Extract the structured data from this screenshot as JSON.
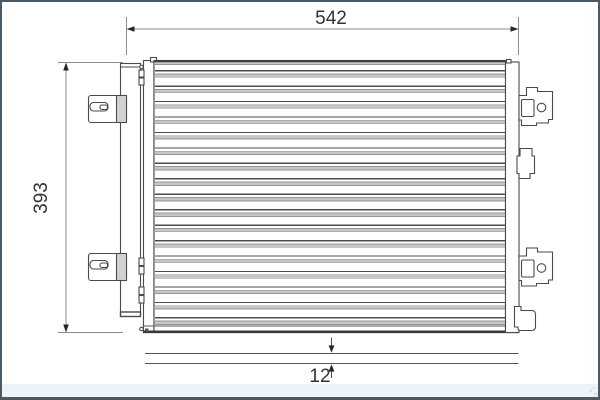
{
  "drawing": {
    "type": "technical-drawing",
    "subject": "condenser-front-and-side-view"
  },
  "dimensions": {
    "width_label": "542",
    "height_label": "393",
    "depth_label": "12"
  },
  "colors": {
    "page_border": "#495a64",
    "outline": "#4a4a4a",
    "core_edge": "#3f3f3f",
    "dim_line": "#8c8c8c",
    "dim_arrow": "#262626",
    "dim_text": "#333333",
    "tube_line": "#4c4c4c",
    "fin_band": "#c6c6c6",
    "fin_edge": "#949494",
    "bracket_shade": "#d2d2d2",
    "footer_strip": "#edf4f8",
    "background": "#ffffff"
  },
  "core": {
    "tube_count": 17,
    "first_tube_y": 70,
    "tube_pitch": 15.45,
    "x": 154.8,
    "width": 350.2,
    "line_height": 1.3,
    "band_offset": 3.5,
    "band_height": 4.2,
    "top_band_y": 61.8,
    "top_band_height": 3.2
  }
}
